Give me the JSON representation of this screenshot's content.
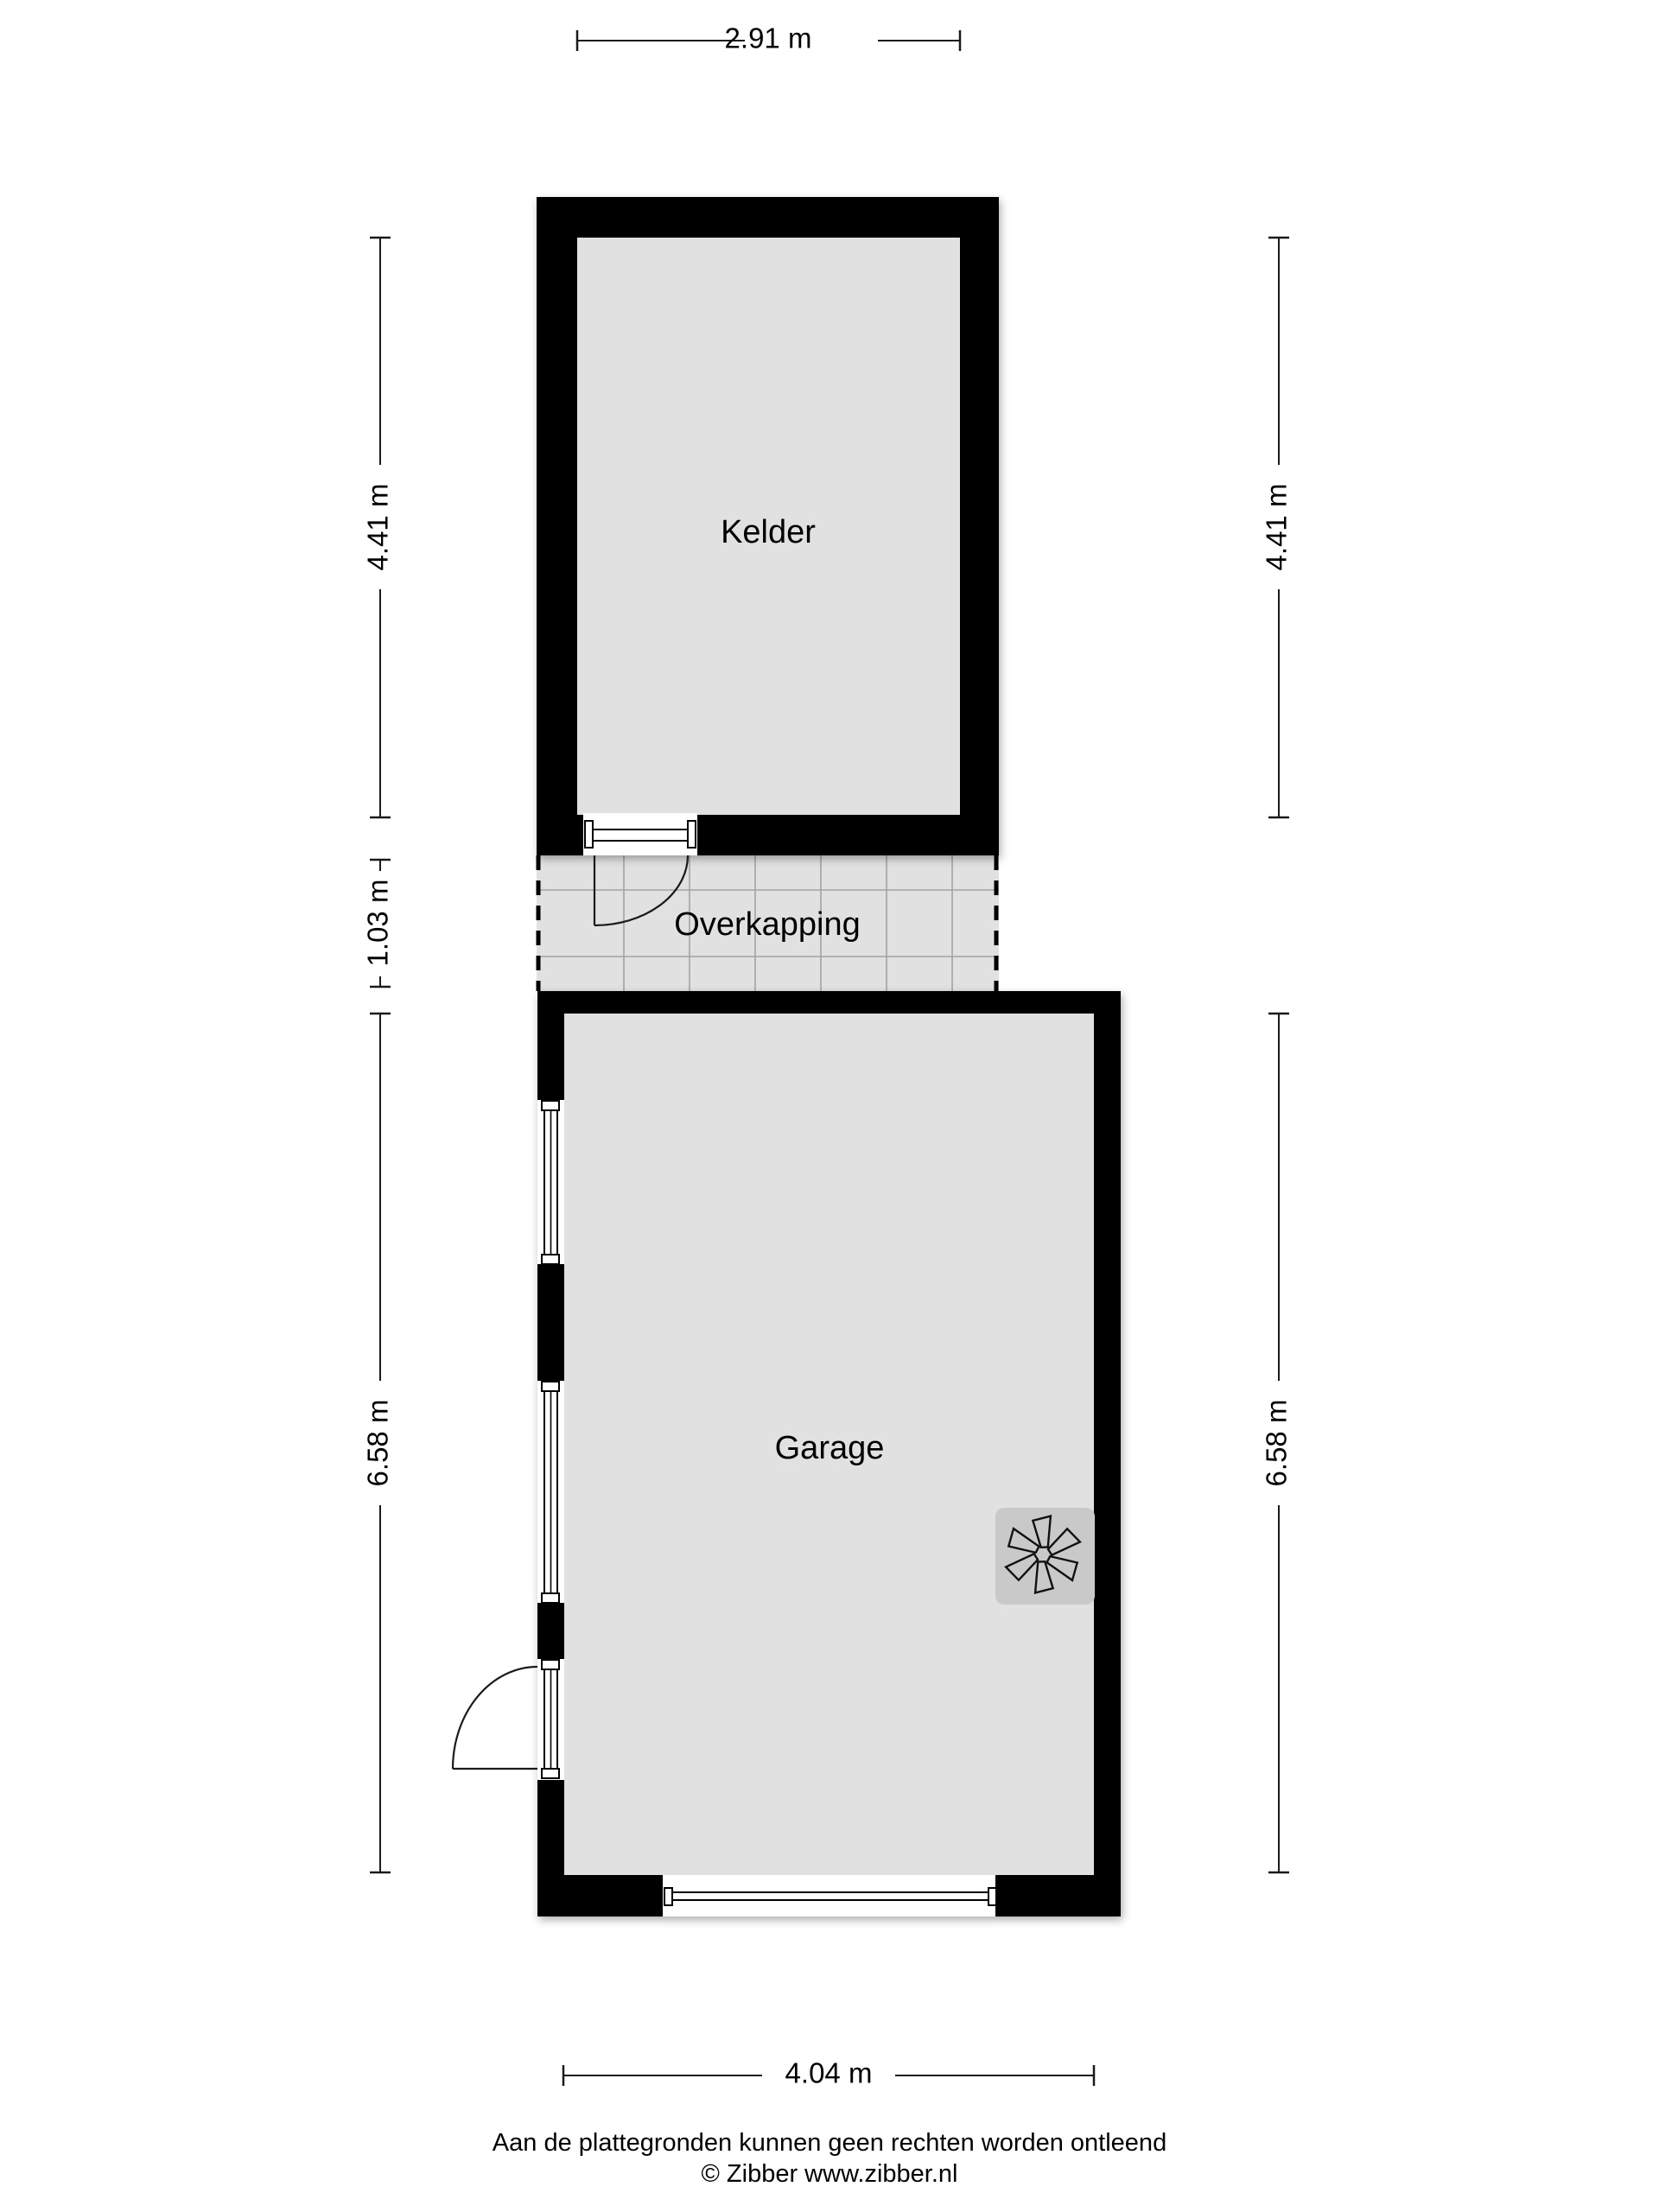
{
  "plan": {
    "title": "Floor plan",
    "rooms": [
      {
        "name": "Kelder"
      },
      {
        "name": "Overkapping"
      },
      {
        "name": "Garage"
      }
    ],
    "dimensions": {
      "top": "2.91 m",
      "left_upper": "4.41 m",
      "left_middle": "1.03 m",
      "left_lower": "6.58 m",
      "right_upper": "4.41 m",
      "right_lower": "6.58 m",
      "bottom": "4.04 m"
    },
    "icons": [
      {
        "name": "fan-icon",
        "meaning": "mechanical ventilation / boiler unit"
      }
    ]
  },
  "footer": {
    "disclaimer": "Aan de plattegronden kunnen geen rechten worden ontleend",
    "credit": "© Zibber www.zibber.nl"
  },
  "colors": {
    "wall": "#000000",
    "floor": "#e1e1e1",
    "tile_line": "#a3a3a3",
    "fan_bg": "#c9c9c9",
    "background": "#ffffff"
  }
}
